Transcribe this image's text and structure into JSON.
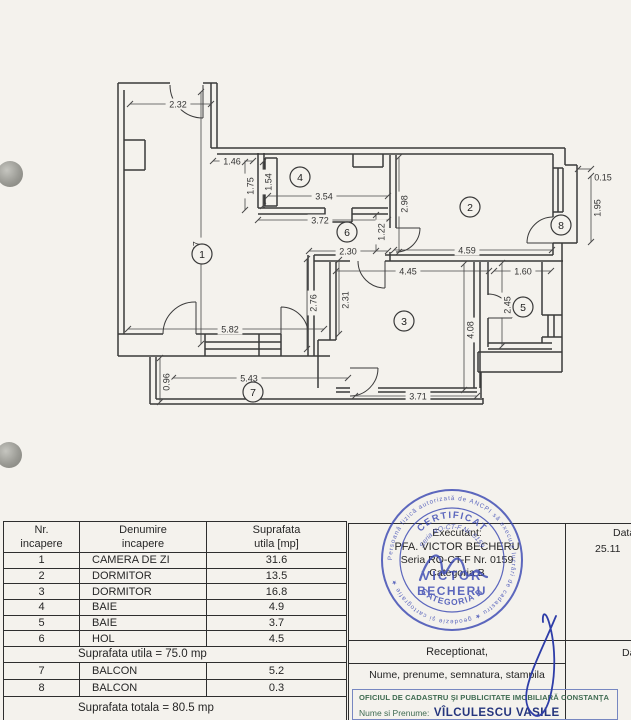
{
  "page": {
    "bg": "#f4f2ed"
  },
  "plan": {
    "wall_color": "#3a3a3a",
    "dim_color": "#474747",
    "walls": [
      [
        118,
        83,
        170,
        83
      ],
      [
        203,
        83,
        217,
        83
      ],
      [
        118,
        83,
        118,
        356
      ],
      [
        124,
        90,
        124,
        334
      ],
      [
        124,
        140,
        145,
        140
      ],
      [
        145,
        140,
        145,
        170
      ],
      [
        124,
        170,
        145,
        170
      ],
      [
        211,
        83,
        211,
        148
      ],
      [
        217,
        83,
        217,
        148
      ],
      [
        211,
        148,
        565,
        148
      ],
      [
        217,
        154,
        553,
        154
      ],
      [
        118,
        334,
        163,
        334
      ],
      [
        196,
        334,
        281,
        334
      ],
      [
        118,
        356,
        330,
        356
      ],
      [
        205,
        334,
        205,
        356
      ],
      [
        259,
        334,
        259,
        356
      ],
      [
        281,
        334,
        281,
        356
      ],
      [
        205,
        342,
        281,
        342
      ],
      [
        205,
        349,
        281,
        349
      ],
      [
        308,
        255,
        308,
        356
      ],
      [
        314,
        255,
        314,
        356
      ],
      [
        330,
        262,
        330,
        340
      ],
      [
        336,
        262,
        336,
        340
      ],
      [
        318,
        340,
        336,
        340
      ],
      [
        318,
        340,
        318,
        388
      ],
      [
        314,
        255,
        350,
        255
      ],
      [
        385,
        255,
        553,
        255
      ],
      [
        314,
        261,
        350,
        261
      ],
      [
        385,
        261,
        563,
        261
      ],
      [
        390,
        155,
        390,
        228
      ],
      [
        396,
        155,
        396,
        228
      ],
      [
        390,
        252,
        390,
        261
      ],
      [
        258,
        153,
        258,
        208
      ],
      [
        264,
        153,
        264,
        208
      ],
      [
        258,
        208,
        325,
        208
      ],
      [
        258,
        214,
        325,
        214
      ],
      [
        325,
        208,
        325,
        222
      ],
      [
        325,
        222,
        352,
        222
      ],
      [
        352,
        222,
        352,
        208
      ],
      [
        352,
        208,
        388,
        208
      ],
      [
        352,
        214,
        388,
        214
      ],
      [
        265,
        158,
        277,
        158
      ],
      [
        277,
        158,
        277,
        206
      ],
      [
        265,
        206,
        277,
        206
      ],
      [
        265,
        158,
        265,
        206
      ],
      [
        353,
        154,
        353,
        167
      ],
      [
        353,
        167,
        383,
        167
      ],
      [
        383,
        167,
        383,
        154
      ],
      [
        553,
        154,
        553,
        168
      ],
      [
        553,
        212,
        553,
        217
      ],
      [
        553,
        243,
        553,
        255
      ],
      [
        553,
        168,
        563,
        168
      ],
      [
        553,
        212,
        563,
        212
      ],
      [
        553,
        168,
        553,
        212
      ],
      [
        558,
        168,
        558,
        212
      ],
      [
        563,
        168,
        563,
        212
      ],
      [
        565,
        148,
        565,
        165
      ],
      [
        565,
        165,
        577,
        165
      ],
      [
        577,
        165,
        577,
        243
      ],
      [
        553,
        243,
        577,
        243
      ],
      [
        474,
        262,
        474,
        388
      ],
      [
        480,
        262,
        480,
        388
      ],
      [
        488,
        262,
        488,
        295
      ],
      [
        488,
        318,
        488,
        347
      ],
      [
        488,
        343,
        552,
        343
      ],
      [
        488,
        349,
        552,
        349
      ],
      [
        542,
        262,
        542,
        315
      ],
      [
        542,
        315,
        562,
        315
      ],
      [
        542,
        337,
        562,
        337
      ],
      [
        548,
        315,
        548,
        337
      ],
      [
        554,
        315,
        554,
        337
      ],
      [
        542,
        337,
        542,
        343
      ],
      [
        562,
        243,
        562,
        372
      ],
      [
        478,
        352,
        562,
        352
      ],
      [
        478,
        372,
        562,
        372
      ],
      [
        478,
        352,
        478,
        372
      ],
      [
        481,
        372,
        481,
        398
      ],
      [
        336,
        388,
        350,
        388
      ],
      [
        378,
        388,
        477,
        388
      ],
      [
        336,
        392,
        350,
        392
      ],
      [
        378,
        392,
        477,
        392
      ],
      [
        150,
        357,
        150,
        404
      ],
      [
        156,
        357,
        156,
        399
      ],
      [
        150,
        404,
        483,
        404
      ],
      [
        156,
        399,
        483,
        399
      ],
      [
        483,
        398,
        483,
        404
      ]
    ],
    "doors": [
      "M203,85 L203,118 M170,85 A33,33 0 0 0 203,118",
      "M196,334 L196,302 M163,334 A32,32 0 0 1 196,302",
      "M281,334 L281,307 M308,334 A27,27 0 0 0 281,307",
      "M385,261 L385,288 M358,261 A27,27 0 0 0 385,288",
      "M396,228 L420,228 M396,252 A24,24 0 0 0 420,228",
      "M553,243 L527,243 M527,243 A26,26 0 0 1 553,217",
      "M488,318 L512,318 M488,294 A24,24 0 0 1 512,318",
      "M350,368 L378,368 M350,396 A28,28 0 0 0 378,368"
    ],
    "dims": [
      {
        "v": "2.32",
        "line": [
          130,
          104,
          211,
          104
        ],
        "x": 178,
        "y": 104,
        "rot": 0
      },
      {
        "v": "7.67",
        "line": [
          201,
          92,
          201,
          344
        ],
        "x": 196,
        "y": 250,
        "rot": 1
      },
      {
        "v": "1.46",
        "line": [
          213,
          161,
          253,
          161
        ],
        "x": 232,
        "y": 161,
        "rot": 0
      },
      {
        "v": "1.75",
        "line": [
          245,
          162,
          245,
          210
        ],
        "x": 250,
        "y": 186,
        "rot": 1
      },
      {
        "v": "1.54",
        "line": [
          263,
          162,
          263,
          206
        ],
        "x": 268,
        "y": 182,
        "rot": 1
      },
      {
        "v": "3.54",
        "line": [
          268,
          196,
          388,
          196
        ],
        "x": 324,
        "y": 196,
        "rot": 0
      },
      {
        "v": "3.72",
        "line": [
          258,
          220,
          388,
          220
        ],
        "x": 320,
        "y": 220,
        "rot": 0
      },
      {
        "v": "2.30",
        "line": [
          309,
          251,
          388,
          251
        ],
        "x": 348,
        "y": 251,
        "rot": 0
      },
      {
        "v": "1.22",
        "line": [
          376,
          215,
          376,
          251
        ],
        "x": 381,
        "y": 232,
        "rot": 1
      },
      {
        "v": "2.98",
        "line": [
          399,
          157,
          399,
          252
        ],
        "x": 404,
        "y": 204,
        "rot": 1
      },
      {
        "v": "4.59",
        "line": [
          394,
          250,
          552,
          250
        ],
        "x": 467,
        "y": 250,
        "rot": 0
      },
      {
        "v": "0.15",
        "line": [
          578,
          169,
          591,
          169
        ],
        "x": 603,
        "y": 177,
        "rot": 0
      },
      {
        "v": "1.95",
        "line": [
          591,
          176,
          591,
          242
        ],
        "x": 597,
        "y": 208,
        "rot": 1
      },
      {
        "v": "4.45",
        "line": [
          336,
          271,
          489,
          271
        ],
        "x": 408,
        "y": 271,
        "rot": 0
      },
      {
        "v": "1.60",
        "line": [
          494,
          271,
          551,
          271
        ],
        "x": 523,
        "y": 271,
        "rot": 0
      },
      {
        "v": "2.45",
        "line": [
          502,
          263,
          502,
          346
        ],
        "x": 507,
        "y": 305,
        "rot": 1
      },
      {
        "v": "2.76",
        "line": [
          307,
          259,
          307,
          349
        ],
        "x": 313,
        "y": 303,
        "rot": 1
      },
      {
        "v": "2.31",
        "line": [
          339,
          260,
          339,
          334
        ],
        "x": 345,
        "y": 300,
        "rot": 1
      },
      {
        "v": "4.08",
        "line": [
          464,
          264,
          464,
          390
        ],
        "x": 470,
        "y": 330,
        "rot": 1
      },
      {
        "v": "5.82",
        "line": [
          128,
          329,
          324,
          329
        ],
        "x": 230,
        "y": 329,
        "rot": 0
      },
      {
        "v": "5.43",
        "line": [
          173,
          378,
          348,
          378
        ],
        "x": 249,
        "y": 378,
        "rot": 0
      },
      {
        "v": "0.96",
        "line": [
          160,
          358,
          160,
          402
        ],
        "x": 166,
        "y": 382,
        "rot": 1
      },
      {
        "v": "3.71",
        "line": [
          355,
          396,
          477,
          396
        ],
        "x": 418,
        "y": 396,
        "rot": 0
      }
    ],
    "rooms": [
      {
        "n": "1",
        "x": 202,
        "y": 254
      },
      {
        "n": "2",
        "x": 470,
        "y": 207
      },
      {
        "n": "3",
        "x": 404,
        "y": 321
      },
      {
        "n": "4",
        "x": 300,
        "y": 177
      },
      {
        "n": "5",
        "x": 523,
        "y": 307
      },
      {
        "n": "6",
        "x": 347,
        "y": 232
      },
      {
        "n": "7",
        "x": 253,
        "y": 392
      },
      {
        "n": "8",
        "x": 561,
        "y": 225
      }
    ]
  },
  "tables": {
    "left": {
      "headers": [
        [
          "Nr.",
          "incapere"
        ],
        [
          "Denumire",
          "incapere"
        ],
        [
          "Suprafata",
          "utila [mp]"
        ]
      ],
      "rows": [
        [
          "1",
          "CAMERA DE ZI",
          "31.6"
        ],
        [
          "2",
          "DORMITOR",
          "13.5"
        ],
        [
          "3",
          "DORMITOR",
          "16.8"
        ],
        [
          "4",
          "BAIE",
          "4.9"
        ],
        [
          "5",
          "BAIE",
          "3.7"
        ],
        [
          "6",
          "HOL",
          "4.5"
        ]
      ],
      "subtotal": "Suprafata utila = 75.0 mp",
      "rows2": [
        [
          "7",
          "BALCON",
          "5.2"
        ],
        [
          "8",
          "BALCON",
          "0.3"
        ]
      ],
      "total": "Suprafata totala = 80.5 mp"
    },
    "right": {
      "executant_label": "Executant:",
      "executant_line1": "PFA. VICTOR BECHERU",
      "executant_line2": "Seria RO-CT-F Nr. 0159",
      "executant_line3": "Categoria B",
      "data_header": "Data",
      "data_value": "25.11",
      "receptionat": "Receptionat,",
      "nume_row": "Nume, prenume, semnatura, stampila",
      "office_box": {
        "border_color": "#7787c1",
        "line1": "OFICIUL DE CADASTRU ŞI PUBLICITATE IMOBILIARĂ CONSTANŢA",
        "name_label": "Nume si Prenume:",
        "name_value": "VÎLCULESCU VASILE"
      }
    }
  },
  "stamp": {
    "color": "#3b49b3",
    "ring_text": "Persoană fizică autorizată de ANCPI să execute lucrări de cadastru ★ geodezie şi cartografie ★",
    "arc1": "CERTIFICAT",
    "arc2": "Seria RO-CT-F Nr. 0159",
    "center1": "VICTOR",
    "center2": "BECHERU",
    "arc3": "CATEGORIA B"
  },
  "signatures": {
    "color": "#2e3da8"
  }
}
